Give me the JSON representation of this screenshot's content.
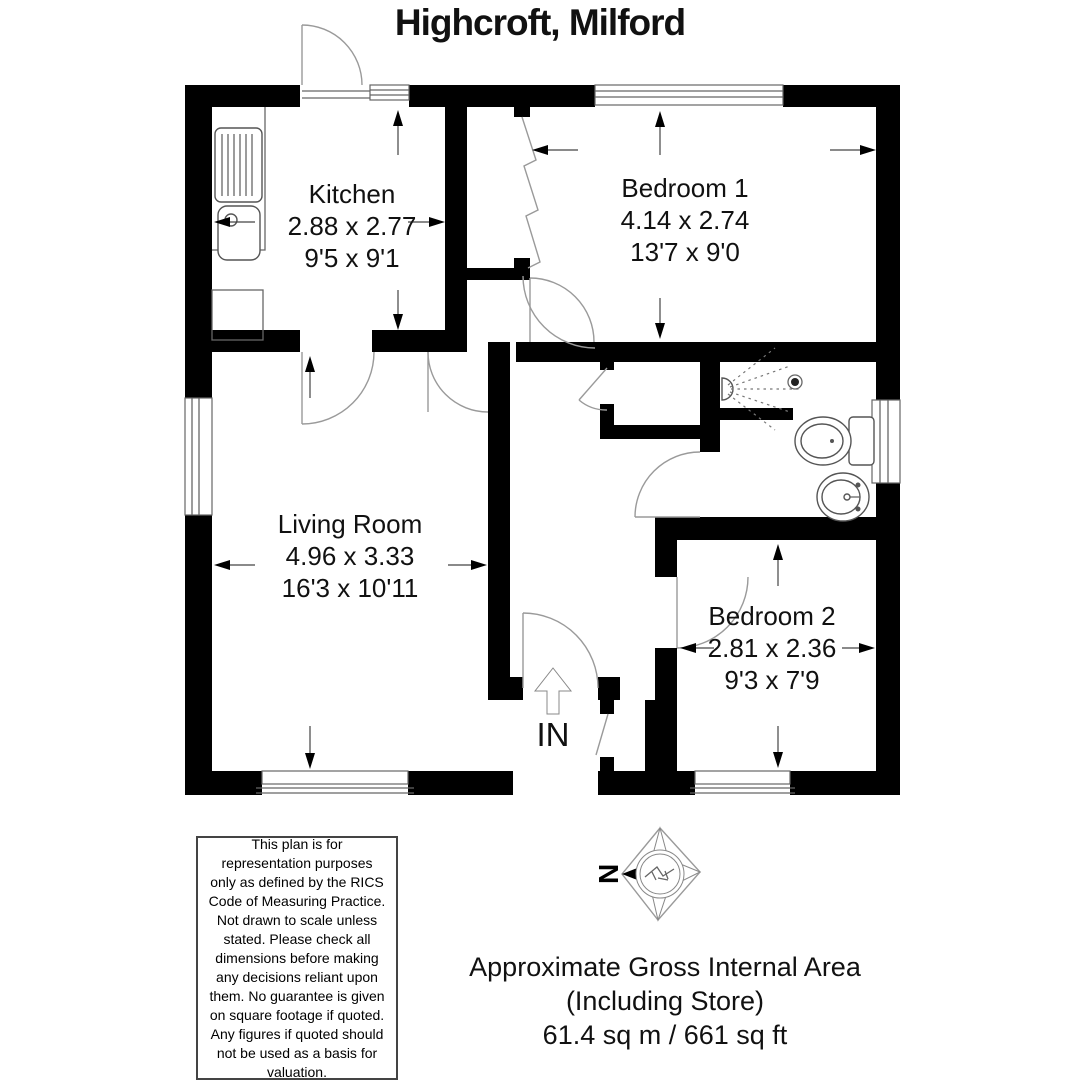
{
  "title": "Highcroft, Milford",
  "entrance_label": "IN",
  "compass": {
    "north_label": "N"
  },
  "rooms": {
    "kitchen": {
      "name": "Kitchen",
      "metric": "2.88 x 2.77",
      "imperial": "9'5 x 9'1"
    },
    "bedroom1": {
      "name": "Bedroom 1",
      "metric": "4.14 x 2.74",
      "imperial": "13'7 x 9'0"
    },
    "living_room": {
      "name": "Living Room",
      "metric": "4.96 x 3.33",
      "imperial": "16'3 x 10'11"
    },
    "bedroom2": {
      "name": "Bedroom 2",
      "metric": "2.81 x 2.36",
      "imperial": "9'3 x 7'9"
    }
  },
  "disclaimer": "This plan is for representation purposes only as defined by the RICS Code of Measuring Practice. Not drawn to scale unless stated. Please check all dimensions before making any decisions reliant upon them. No guarantee is given on square footage if quoted. Any figures if quoted should not be used as a basis for valuation.",
  "area": {
    "line1": "Approximate Gross Internal Area",
    "line2": "(Including Store)",
    "line3": "61.4 sq m / 661 sq ft"
  },
  "colors": {
    "wall": "#000000",
    "door_arc": "#9a9a9a",
    "detail_line": "#666666"
  }
}
